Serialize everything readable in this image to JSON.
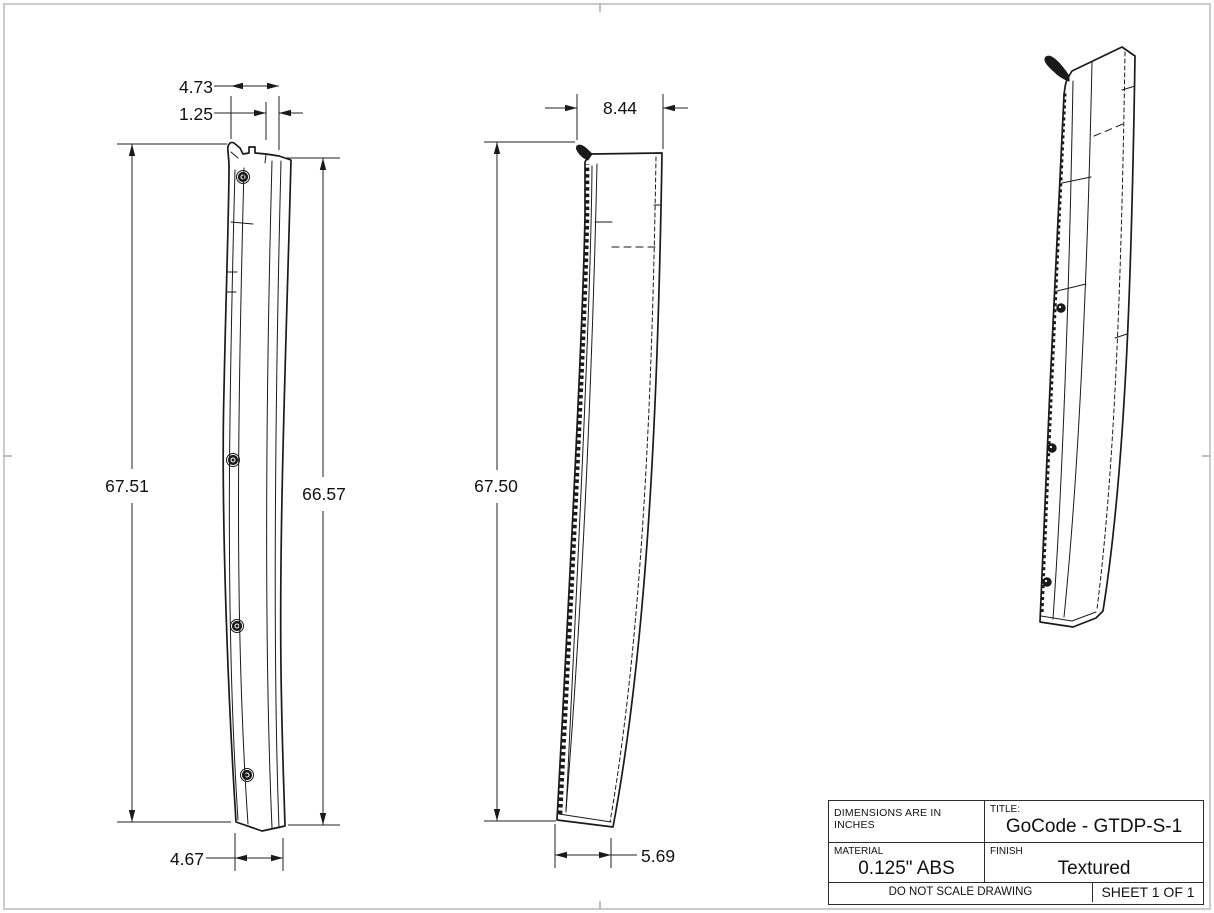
{
  "sheet": {
    "border_color": "#cbcbcb",
    "line_color": "#1a1a1a",
    "background": "#ffffff"
  },
  "front_view": {
    "description": "front profile view of tall curved pillar trim panel with hook at top and four fastener clips",
    "dims": {
      "top_width": "4.73",
      "top_flange": "1.25",
      "height_overall": "67.51",
      "height_right": "66.57",
      "bottom_width": "4.67"
    }
  },
  "side_view": {
    "description": "side profile view with stitched clip edge and hidden lines",
    "dims": {
      "top_width": "8.44",
      "height_overall": "67.50",
      "bottom_width": "5.69"
    }
  },
  "isometric_view": {
    "description": "isometric view of panel with hook, hidden dashed edges and three fastener clips"
  },
  "title_block": {
    "dimensions_note": "DIMENSIONS ARE IN INCHES",
    "title_label": "TITLE:",
    "title_value": "GoCode - GTDP-S-1",
    "material_label": "MATERIAL",
    "material_value": "0.125\" ABS",
    "finish_label": "FINISH",
    "finish_value": "Textured",
    "scale_note": "DO NOT SCALE DRAWING",
    "sheet_note": "SHEET 1 OF 1"
  }
}
